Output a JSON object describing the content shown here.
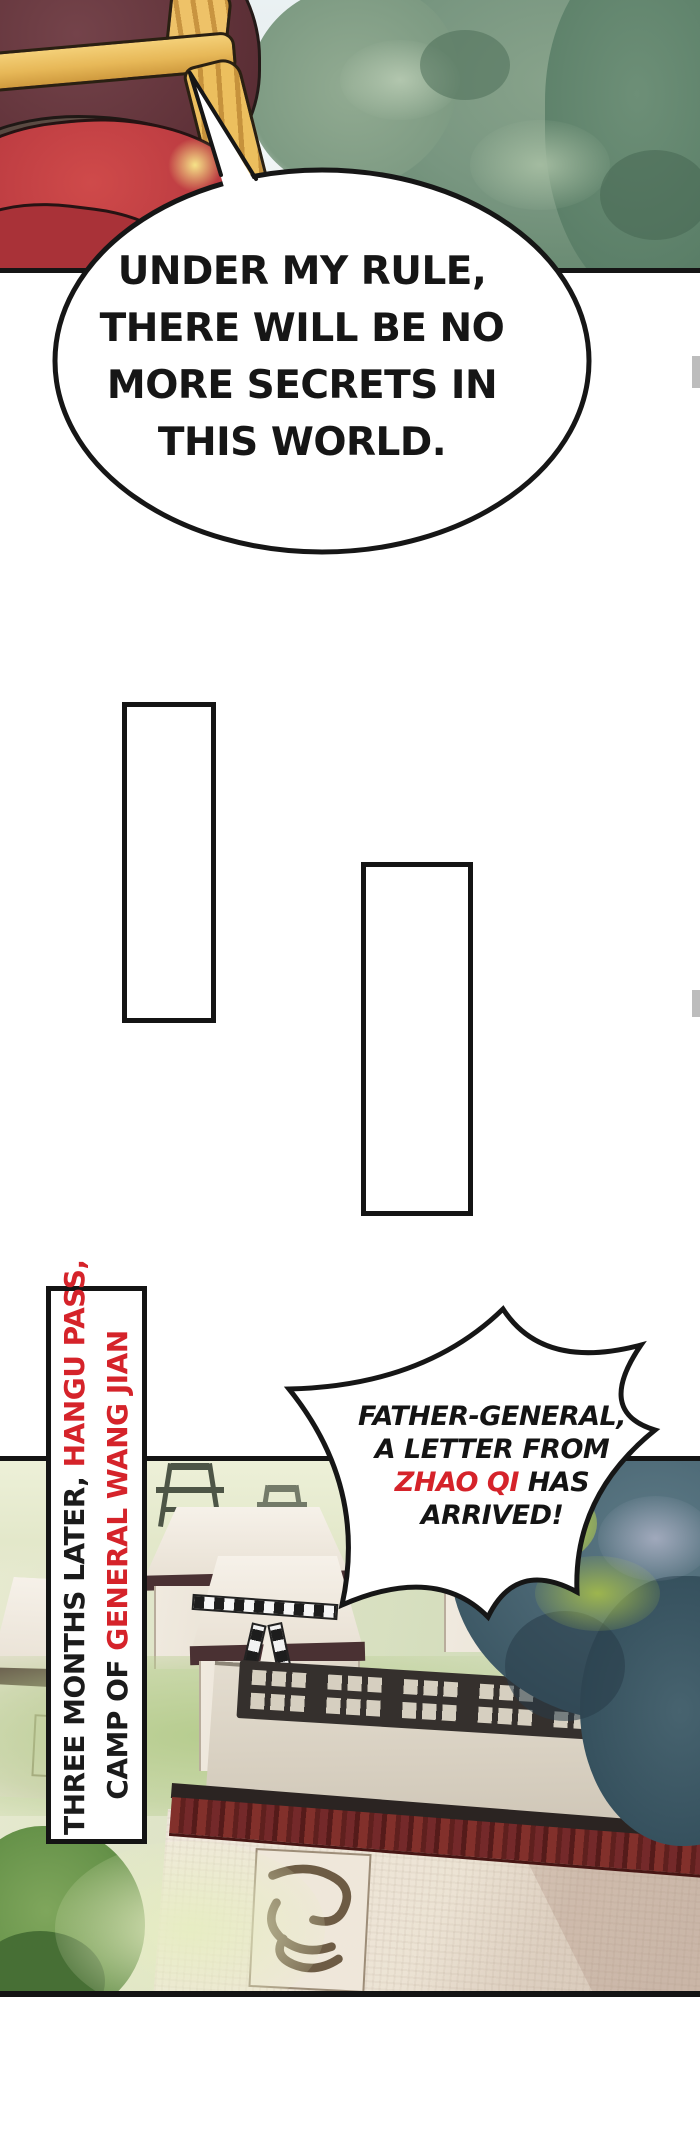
{
  "comic": {
    "bubble_main": {
      "lines": [
        "UNDER MY RULE,",
        "THERE WILL BE NO",
        "MORE SECRETS IN",
        "THIS WORLD."
      ]
    },
    "caption": {
      "line1_black": "THREE MONTHS LATER, ",
      "line1_red": "HANGU PASS,",
      "line2_black": "CAMP OF ",
      "line2_red": "GENERAL WANG JIAN"
    },
    "bubble_shout": {
      "line1": "FATHER-GENERAL,",
      "line2": "A LETTER FROM",
      "line3_red": "ZHAO QI",
      "line3_black": " HAS",
      "line4": "ARRIVED!"
    },
    "colors": {
      "ink": "#151515",
      "accent_red": "#d5232a",
      "paper": "#ffffff",
      "edge_tab_gray": "#bdbdbd"
    }
  }
}
